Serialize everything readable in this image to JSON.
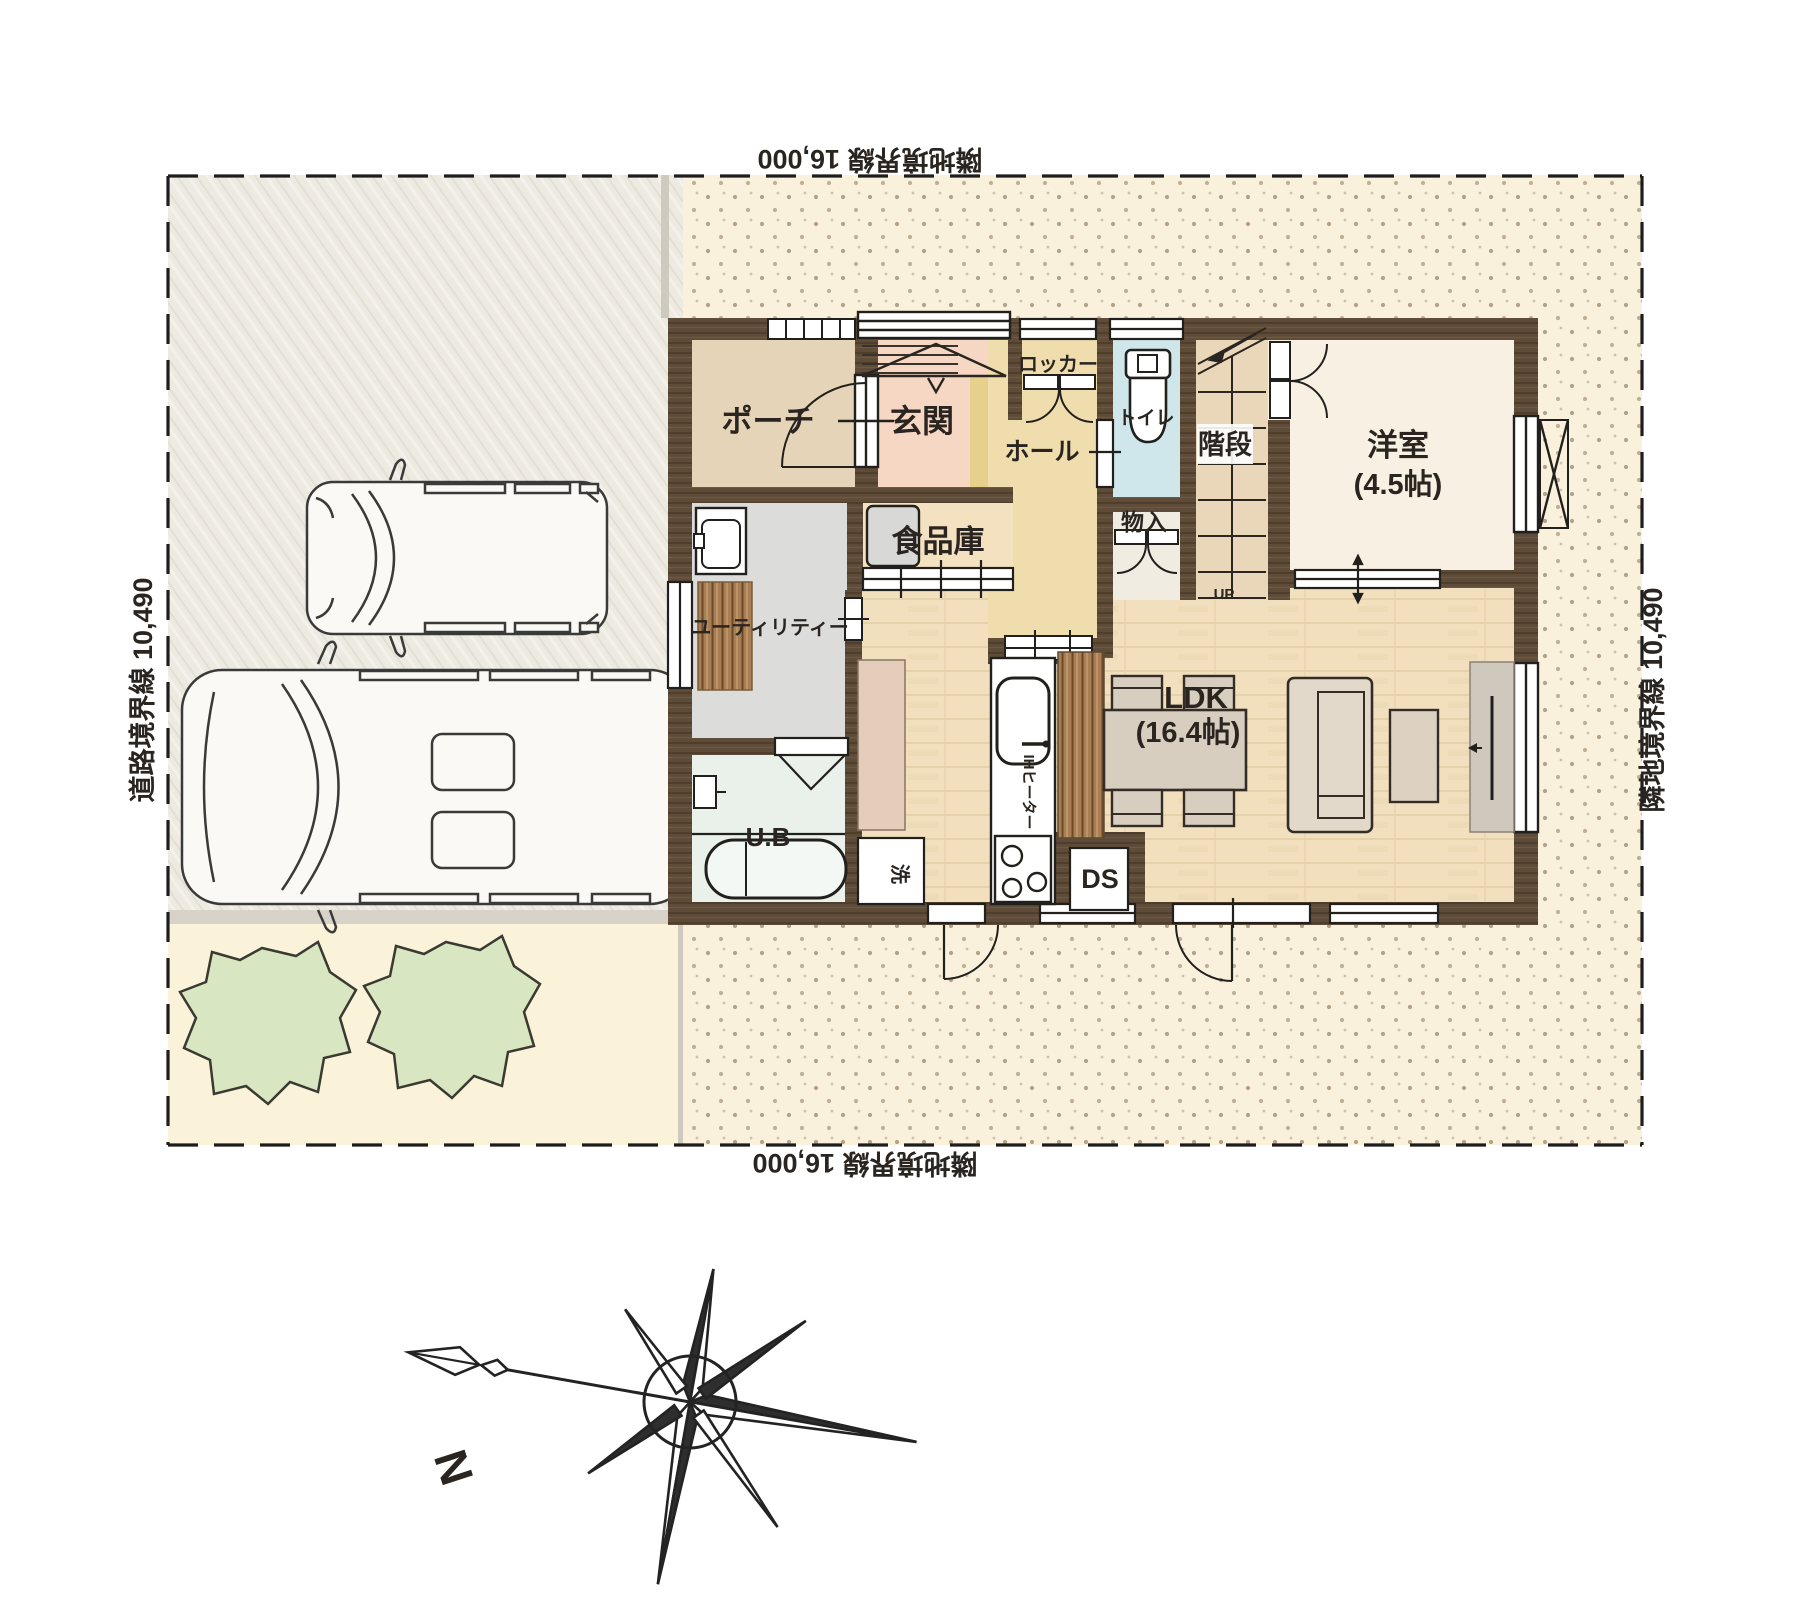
{
  "boundaries": {
    "top": "隣地境界線 16,000",
    "bottom": "隣地境界線 16,000",
    "left": "道路境界線 10,490",
    "right": "隣地境界線 10,490"
  },
  "rooms": {
    "porch": "ポーチ",
    "entrance": "玄関",
    "hall": "ホール",
    "locker": "ロッカー",
    "toilet": "トイレ",
    "stairs": "階段",
    "stairs_up": "UP",
    "storage": "物入",
    "western_room": "洋室",
    "western_room_size": "(4.5帖)",
    "pantry": "食品庫",
    "utility": "ユーティリティー",
    "unit_bath": "U.B",
    "laundry": "洗",
    "ih_heater": "IHヒーター",
    "duct_space": "DS",
    "ldk": "LDK",
    "ldk_size": "(16.4帖)"
  },
  "compass": {
    "north": "N"
  },
  "colors": {
    "wall": "#5e4b38",
    "lot_fill": "#faf1dc",
    "driveway_fill": "#edeae2",
    "garden_fill": "#faf3d9",
    "tree_fill": "#d8e6c2",
    "ldk_floor": "#f1dfbd",
    "entrance_floor": "#f6d7c3",
    "hall_floor": "#efddae",
    "toilet_floor": "#cfe7ea",
    "utility_floor": "#dcdcda",
    "bath_floor": "#e9f1ea",
    "western_room_floor": "#f8f0e2",
    "porch_floor": "#e6d4b8",
    "stairs_floor": "#ead6b8",
    "wood_slat": "#a87f55"
  }
}
